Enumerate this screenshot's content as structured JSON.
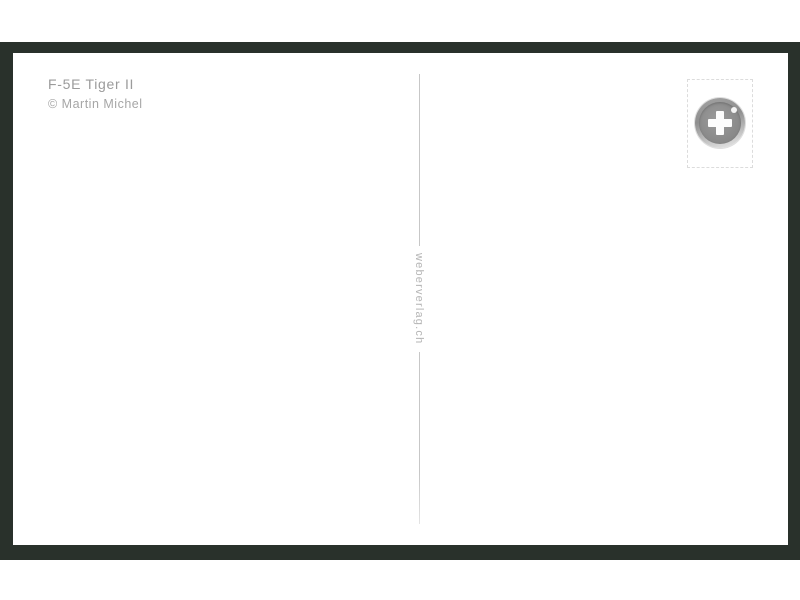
{
  "postcard": {
    "title": "F-5E Tiger II",
    "credit": "© Martin Michel",
    "divider_text": "weberverlag.ch",
    "stamp": {
      "logo_icon": "swiss-cross-circle-logo"
    },
    "colors": {
      "frame": "#29312b",
      "card": "#ffffff",
      "title_text": "#9b9b9b",
      "credit_text": "#a6a6a6",
      "divider_line": "#c7c7c7",
      "divider_text_color": "#b5b5b5",
      "stamp_border": "#dcdcdc",
      "logo_gray": "#8f8f8f",
      "cross": "#ffffff"
    }
  }
}
